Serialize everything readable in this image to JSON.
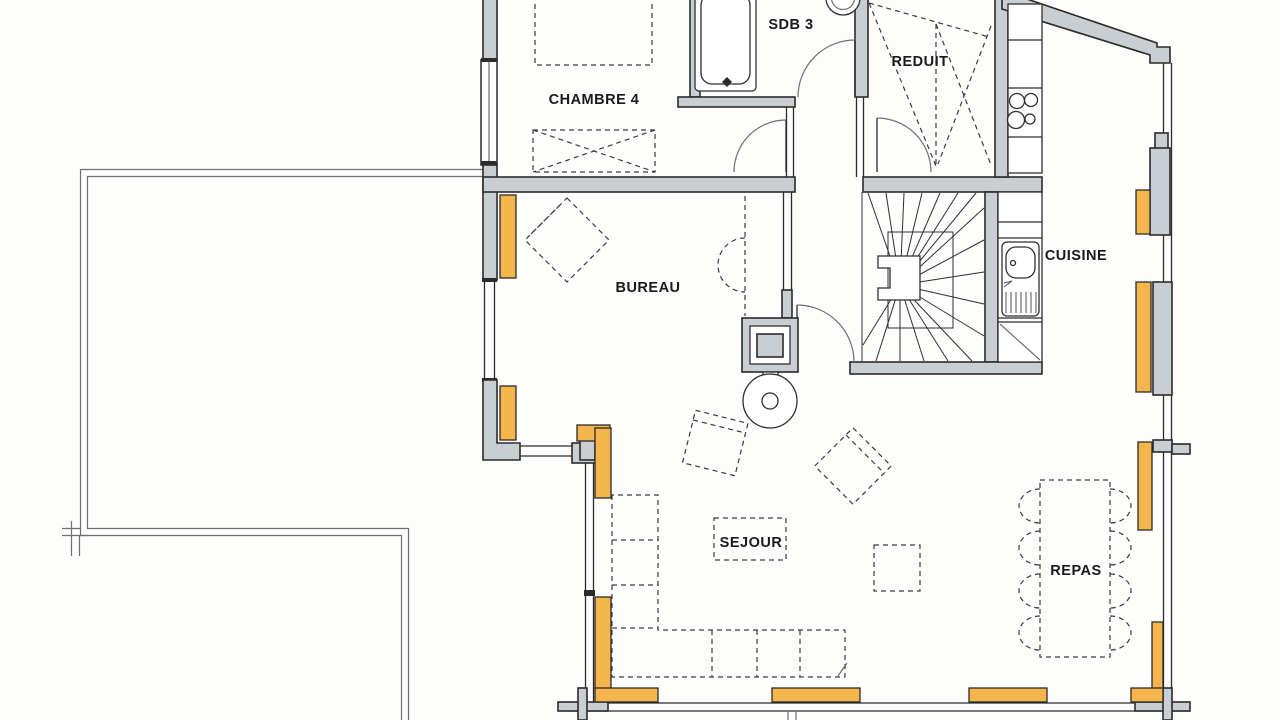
{
  "plan": {
    "type": "scanned-floor-plan",
    "rooms": [
      {
        "id": "chambre-4",
        "label": "CHAMBRE 4"
      },
      {
        "id": "sdb-3",
        "label": "SDB 3"
      },
      {
        "id": "reduit",
        "label": "REDUIT"
      },
      {
        "id": "cuisine",
        "label": "CUISINE"
      },
      {
        "id": "bureau",
        "label": "BUREAU"
      },
      {
        "id": "sejour",
        "label": "SEJOUR"
      },
      {
        "id": "repas",
        "label": "REPAS"
      }
    ],
    "colors": {
      "wall": "#c9ced3",
      "window": "#f4b54c",
      "line": "#2b2b2b",
      "thin": "#6f6f6f",
      "paper": "#fdfdfc"
    },
    "glyphs": {
      "fixtures": [
        "bathtub",
        "washbasin",
        "cooktop-4-burners",
        "kitchen-sink",
        "winder-staircase",
        "chimney",
        "wood-stove"
      ],
      "furniture": [
        "bed",
        "wardrobe-cross",
        "storage-cross",
        "desk-diamond",
        "desk-chair",
        "armchair",
        "armchair",
        "corner-sofa",
        "coffee-table",
        "side-table",
        "dining-table-8-chairs"
      ],
      "doors": 4
    }
  }
}
